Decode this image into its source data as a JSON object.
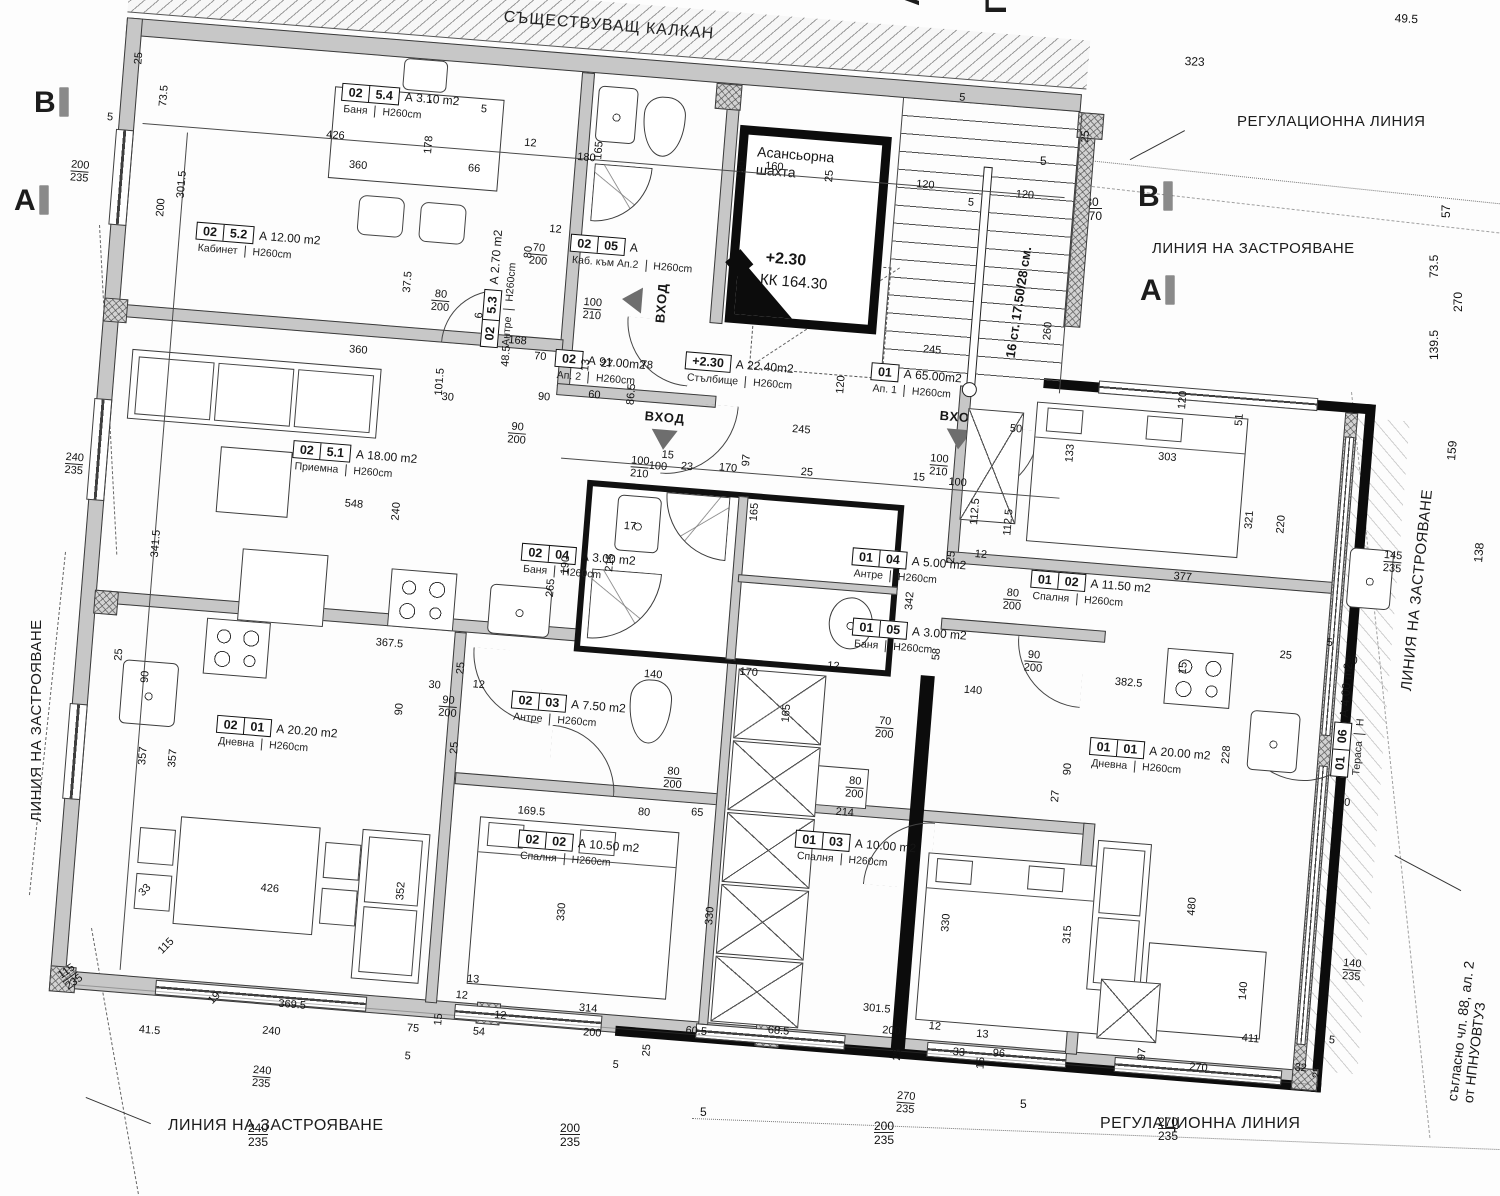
{
  "plan": {
    "kalkan": "СЪЩЕСТВУВАЩ КАЛКАН",
    "entrance_label": "ВХОД",
    "elevator": {
      "line1": "Асансьорна",
      "line2": "шахта"
    },
    "level": {
      "mark": "+2.30",
      "kk": "КК   164.30"
    },
    "stairs_note": "16 ст. 17.50/28 см.",
    "annotations": {
      "regulation_line_top": "РЕГУЛАЦИОННА ЛИНИЯ",
      "regulation_line_bottom": "РЕГУЛАЦИОННА ЛИНИЯ",
      "building_line_top": "ЛИНИЯ НА ЗАСТРОЯВАНЕ",
      "building_line_left": "ЛИНИЯ НА ЗАСТРОЯВАНЕ",
      "building_line_right": "ЛИНИЯ НА ЗАСТРОЯВАНЕ",
      "building_line_bottom": "ЛИНИЯ НА ЗАСТРОЯВАНЕ",
      "legal_note_line1": "съгласно чл. 88, ал. 2",
      "legal_note_line2": "от НПНУОВТУЗ"
    }
  },
  "section_markers": [
    {
      "l": "В",
      "x": 34,
      "y": 86
    },
    {
      "l": "А",
      "x": 14,
      "y": 184
    },
    {
      "l": "В",
      "x": 1138,
      "y": 180
    },
    {
      "l": "А",
      "x": 1140,
      "y": 274
    },
    {
      "l": "А",
      "x": 893,
      "y": 6,
      "r": -90
    },
    {
      "l": "Г",
      "x": 980,
      "y": 14,
      "r": -90
    }
  ],
  "rooms": [
    {
      "c1": "02",
      "c2": "5.4",
      "area": "А 3.10 m2",
      "name": "Баня",
      "h": "H260cm",
      "x": 212,
      "y": 48
    },
    {
      "c1": "02",
      "c2": "5.2",
      "area": "А 12.00 m2",
      "name": "Кабинет",
      "h": "H260cm",
      "x": 78,
      "y": 198
    },
    {
      "c1": "02",
      "c2": "5.3",
      "area": "А  2.70 m2",
      "name": "Антре",
      "h": "H260cm",
      "x": 370,
      "y": 300,
      "r": -90
    },
    {
      "c1": "02",
      "c2": "5.1",
      "area": "А 18.00 m2",
      "name": "Приемна",
      "h": "H260cm",
      "x": 192,
      "y": 408
    },
    {
      "c1": "02",
      "c2": "05",
      "area": "А",
      "name": "Каб. към Ап.2",
      "h": "H260cm",
      "x": 452,
      "y": 180
    },
    {
      "c1": "02",
      "c2": "",
      "area": "А  91.00m2",
      "name": "Ап. 2",
      "h": "H260cm",
      "x": 446,
      "y": 296
    },
    {
      "c1": "+2.30",
      "c2": "",
      "area": "А  22.40m2",
      "name": "Стълбище",
      "h": "H260cm",
      "x": 576,
      "y": 288
    },
    {
      "c1": "01",
      "c2": "",
      "area": "А  65.00m2",
      "name": "Ап. 1",
      "h": "H260cm",
      "x": 762,
      "y": 284
    },
    {
      "c1": "02",
      "c2": "04",
      "area": "А 3.00 m2",
      "name": "Баня",
      "h": "H260cm",
      "x": 428,
      "y": 492
    },
    {
      "c1": "01",
      "c2": "04",
      "area": "А  5.00 m2",
      "name": "Антре",
      "h": "H260cm",
      "x": 758,
      "y": 470
    },
    {
      "c1": "01",
      "c2": "05",
      "area": "А 3.00 m2",
      "name": "Баня",
      "h": "H260cm",
      "x": 764,
      "y": 540
    },
    {
      "c1": "01",
      "c2": "02",
      "area": "А 11.50 m2",
      "name": "Спалня",
      "h": "H260cm",
      "x": 938,
      "y": 478
    },
    {
      "c1": "02",
      "c2": "03",
      "area": "А  7.50 m2",
      "name": "Антре",
      "h": "H260cm",
      "x": 430,
      "y": 640
    },
    {
      "c1": "02",
      "c2": "01",
      "area": "А 20.20 m2",
      "name": "Дневна",
      "h": "H260cm",
      "x": 138,
      "y": 688
    },
    {
      "c1": "02",
      "c2": "02",
      "area": "А 10.50 m2",
      "name": "Спалня",
      "h": "H260cm",
      "x": 448,
      "y": 778
    },
    {
      "c1": "01",
      "c2": "03",
      "area": "А 10.00 m2",
      "name": "Спалня",
      "h": "H260cm",
      "x": 724,
      "y": 756
    },
    {
      "c1": "01",
      "c2": "01",
      "area": "А 20.00 m2",
      "name": "Дневна",
      "h": "H260cm",
      "x": 1010,
      "y": 640
    },
    {
      "c1": "01",
      "c2": "06",
      "area": "А 4.00 m2",
      "name": "Тераса",
      "h": "Н",
      "x": 1252,
      "y": 660,
      "r": -90
    }
  ],
  "dims": [
    {
      "t": "25",
      "x": 2,
      "y": 46,
      "r": -90
    },
    {
      "t": "73.5",
      "x": 30,
      "y": 86,
      "r": -90
    },
    {
      "t": "5",
      "x": -20,
      "y": 96
    },
    {
      "t": "200/235",
      "x": -52,
      "y": 146,
      "f": 1
    },
    {
      "t": "301.5",
      "x": 55,
      "y": 176,
      "r": -90
    },
    {
      "t": "200",
      "x": 36,
      "y": 196,
      "r": -90
    },
    {
      "t": "426",
      "x": 200,
      "y": 96
    },
    {
      "t": "178",
      "x": 298,
      "y": 112,
      "r": -90
    },
    {
      "t": "360",
      "x": 225,
      "y": 124
    },
    {
      "t": "12",
      "x": 398,
      "y": 88
    },
    {
      "t": "66",
      "x": 344,
      "y": 118
    },
    {
      "t": "5",
      "x": 352,
      "y": 58
    },
    {
      "t": "180",
      "x": 452,
      "y": 98
    },
    {
      "t": "165",
      "x": 468,
      "y": 104,
      "r": -90
    },
    {
      "t": "190",
      "x": 612,
      "y": 112,
      "r": -90
    },
    {
      "t": "160",
      "x": 640,
      "y": 92
    },
    {
      "t": "25",
      "x": 700,
      "y": 108,
      "r": -90
    },
    {
      "t": "120",
      "x": 792,
      "y": 98
    },
    {
      "t": "120",
      "x": 892,
      "y": 100
    },
    {
      "t": "5",
      "x": 828,
      "y": 8
    },
    {
      "t": "25",
      "x": 952,
      "y": 48,
      "r": -90
    },
    {
      "t": "120",
      "x": 728,
      "y": 318,
      "r": -90
    },
    {
      "t": "260",
      "x": 930,
      "y": 248,
      "r": -90
    },
    {
      "t": "5",
      "x": 845,
      "y": 112
    },
    {
      "t": "70",
      "x": 425,
      "y": 300
    },
    {
      "t": "27",
      "x": 492,
      "y": 302
    },
    {
      "t": "78",
      "x": 532,
      "y": 300
    },
    {
      "t": "12",
      "x": 430,
      "y": 172
    },
    {
      "t": "37.5",
      "x": 288,
      "y": 252,
      "r": -90
    },
    {
      "t": "80",
      "x": 406,
      "y": 208,
      "r": -90
    },
    {
      "t": "80/200",
      "x": 318,
      "y": 246,
      "f": 1
    },
    {
      "t": "6",
      "x": 362,
      "y": 272,
      "r": -90
    },
    {
      "t": "48.5",
      "x": 392,
      "y": 318,
      "r": -90
    },
    {
      "t": "360",
      "x": 240,
      "y": 308
    },
    {
      "t": "30",
      "x": 336,
      "y": 348
    },
    {
      "t": "90",
      "x": 432,
      "y": 340
    },
    {
      "t": "60",
      "x": 482,
      "y": 334
    },
    {
      "t": "86.5",
      "x": 520,
      "y": 346,
      "r": -90
    },
    {
      "t": "168",
      "x": 398,
      "y": 286
    },
    {
      "t": "90/200",
      "x": 405,
      "y": 372,
      "f": 1
    },
    {
      "t": "100/210",
      "x": 470,
      "y": 242,
      "f": 1
    },
    {
      "t": "70/200",
      "x": 412,
      "y": 192,
      "f": 1
    },
    {
      "t": "13",
      "x": 472,
      "y": 316,
      "r": -90
    },
    {
      "t": "245",
      "x": 812,
      "y": 262
    },
    {
      "t": "245",
      "x": 688,
      "y": 352
    },
    {
      "t": "97",
      "x": 640,
      "y": 398,
      "r": -90
    },
    {
      "t": "15",
      "x": 560,
      "y": 388
    },
    {
      "t": "50",
      "x": 905,
      "y": 334
    },
    {
      "t": "100/210",
      "x": 530,
      "y": 396,
      "f": 1
    },
    {
      "t": "100/210",
      "x": 828,
      "y": 370,
      "f": 1
    },
    {
      "t": "120",
      "x": 1070,
      "y": 306,
      "r": -90
    },
    {
      "t": "303",
      "x": 1055,
      "y": 350
    },
    {
      "t": "51",
      "x": 1128,
      "y": 318,
      "r": -90
    },
    {
      "t": "133",
      "x": 962,
      "y": 368,
      "r": -90
    },
    {
      "t": "321",
      "x": 1146,
      "y": 420,
      "r": -90
    },
    {
      "t": "220",
      "x": 1178,
      "y": 422,
      "r": -90
    },
    {
      "t": "377",
      "x": 1080,
      "y": 468
    },
    {
      "t": "112.5",
      "x": 872,
      "y": 438,
      "r": -90
    },
    {
      "t": "112.5",
      "x": 906,
      "y": 446,
      "r": -90
    },
    {
      "t": "25",
      "x": 852,
      "y": 478,
      "r": -90
    },
    {
      "t": "12",
      "x": 880,
      "y": 462
    },
    {
      "t": "145/235",
      "x": 1288,
      "y": 430,
      "f": 1
    },
    {
      "t": "80/200",
      "x": 912,
      "y": 498,
      "f": 1
    },
    {
      "t": "17",
      "x": 528,
      "y": 462
    },
    {
      "t": "100",
      "x": 548,
      "y": 400
    },
    {
      "t": "23",
      "x": 580,
      "y": 398
    },
    {
      "t": "170",
      "x": 618,
      "y": 396
    },
    {
      "t": "165",
      "x": 652,
      "y": 452,
      "r": -90
    },
    {
      "t": "25",
      "x": 700,
      "y": 394
    },
    {
      "t": "215",
      "x": 512,
      "y": 514,
      "r": -90
    },
    {
      "t": "265",
      "x": 455,
      "y": 544,
      "r": -90
    },
    {
      "t": "190",
      "x": 468,
      "y": 520,
      "r": -90
    },
    {
      "t": "100",
      "x": 848,
      "y": 392
    },
    {
      "t": "15",
      "x": 812,
      "y": 390
    },
    {
      "t": "342",
      "x": 814,
      "y": 528,
      "r": -90
    },
    {
      "t": "58",
      "x": 845,
      "y": 576,
      "r": -90
    },
    {
      "t": "170",
      "x": 655,
      "y": 598
    },
    {
      "t": "165",
      "x": 700,
      "y": 650,
      "r": -90
    },
    {
      "t": "12",
      "x": 742,
      "y": 585
    },
    {
      "t": "140",
      "x": 560,
      "y": 608
    },
    {
      "t": "140",
      "x": 880,
      "y": 598
    },
    {
      "t": "70/200",
      "x": 795,
      "y": 636,
      "f": 1
    },
    {
      "t": "80/200",
      "x": 770,
      "y": 698,
      "f": 1
    },
    {
      "t": "90/200",
      "x": 938,
      "y": 558,
      "f": 1
    },
    {
      "t": "80/200",
      "x": 588,
      "y": 703,
      "f": 1
    },
    {
      "t": "548",
      "x": 248,
      "y": 462
    },
    {
      "t": "367.5",
      "x": 290,
      "y": 598
    },
    {
      "t": "341.5",
      "x": 58,
      "y": 536,
      "r": -90
    },
    {
      "t": "240",
      "x": 295,
      "y": 480,
      "r": -90
    },
    {
      "t": "101.5",
      "x": 328,
      "y": 352,
      "r": -90
    },
    {
      "t": "240/235",
      "x": -34,
      "y": 438,
      "f": 1
    },
    {
      "t": "357",
      "x": 62,
      "y": 744,
      "r": -90
    },
    {
      "t": "357",
      "x": 92,
      "y": 744,
      "r": -90
    },
    {
      "t": "115/235",
      "x": -2,
      "y": 958,
      "f": 1,
      "r": -40
    },
    {
      "t": "30",
      "x": 346,
      "y": 636
    },
    {
      "t": "90",
      "x": 314,
      "y": 674,
      "r": -90
    },
    {
      "t": "90/200",
      "x": 358,
      "y": 650,
      "f": 1
    },
    {
      "t": "12",
      "x": 390,
      "y": 632
    },
    {
      "t": "25",
      "x": 372,
      "y": 628,
      "r": -90
    },
    {
      "t": "25",
      "x": 372,
      "y": 708,
      "r": -90
    },
    {
      "t": "90",
      "x": 58,
      "y": 662,
      "r": -90
    },
    {
      "t": "25",
      "x": 30,
      "y": 642,
      "r": -90
    },
    {
      "t": "426",
      "x": 195,
      "y": 852
    },
    {
      "t": "33",
      "x": 72,
      "y": 870,
      "r": -50
    },
    {
      "t": "115",
      "x": 96,
      "y": 926,
      "r": -50
    },
    {
      "t": "19",
      "x": 150,
      "y": 972,
      "r": -50
    },
    {
      "t": "369.5",
      "x": 222,
      "y": 966
    },
    {
      "t": "41.5",
      "x": 85,
      "y": 1003
    },
    {
      "t": "240",
      "x": 208,
      "y": 994
    },
    {
      "t": "352",
      "x": 330,
      "y": 858,
      "r": -90
    },
    {
      "t": "75",
      "x": 352,
      "y": 980
    },
    {
      "t": "15",
      "x": 378,
      "y": 980,
      "r": -90
    },
    {
      "t": "12",
      "x": 398,
      "y": 943
    },
    {
      "t": "13",
      "x": 408,
      "y": 926
    },
    {
      "t": "240/235",
      "x": 202,
      "y": 1034,
      "f": 1
    },
    {
      "t": "5",
      "x": 352,
      "y": 1008
    },
    {
      "t": "169.5",
      "x": 445,
      "y": 754
    },
    {
      "t": "80",
      "x": 565,
      "y": 746
    },
    {
      "t": "65",
      "x": 618,
      "y": 742
    },
    {
      "t": "214",
      "x": 762,
      "y": 730
    },
    {
      "t": "330",
      "x": 492,
      "y": 866,
      "r": -90
    },
    {
      "t": "330",
      "x": 640,
      "y": 858,
      "r": -90
    },
    {
      "t": "330",
      "x": 876,
      "y": 846,
      "r": -90
    },
    {
      "t": "314",
      "x": 522,
      "y": 946
    },
    {
      "t": "301.5",
      "x": 805,
      "y": 923
    },
    {
      "t": "54",
      "x": 418,
      "y": 978
    },
    {
      "t": "200",
      "x": 528,
      "y": 970
    },
    {
      "t": "60.5",
      "x": 630,
      "y": 960
    },
    {
      "t": "68.5",
      "x": 712,
      "y": 953
    },
    {
      "t": "200",
      "x": 826,
      "y": 944
    },
    {
      "t": "12",
      "x": 438,
      "y": 960
    },
    {
      "t": "25",
      "x": 588,
      "y": 994,
      "r": -90
    },
    {
      "t": "25",
      "x": 838,
      "y": 978,
      "r": -90
    },
    {
      "t": "5",
      "x": 560,
      "y": 1000
    },
    {
      "t": "382.5",
      "x": 1030,
      "y": 578
    },
    {
      "t": "228",
      "x": 1142,
      "y": 656,
      "r": -90
    },
    {
      "t": "480",
      "x": 1120,
      "y": 810,
      "r": -90
    },
    {
      "t": "315",
      "x": 998,
      "y": 848,
      "r": -90
    },
    {
      "t": "27",
      "x": 975,
      "y": 708,
      "r": -90
    },
    {
      "t": "90",
      "x": 985,
      "y": 680,
      "r": -90
    },
    {
      "t": "15",
      "x": 1092,
      "y": 570,
      "r": -90
    },
    {
      "t": "25",
      "x": 1192,
      "y": 538
    },
    {
      "t": "5",
      "x": 1238,
      "y": 522
    },
    {
      "t": "60",
      "x": 1258,
      "y": 538
    },
    {
      "t": "90",
      "x": 1262,
      "y": 680
    },
    {
      "t": "140",
      "x": 1178,
      "y": 890,
      "r": -90
    },
    {
      "t": "140/235",
      "x": 1280,
      "y": 840,
      "f": 1
    },
    {
      "t": "411",
      "x": 1185,
      "y": 923
    },
    {
      "t": "270",
      "x": 1135,
      "y": 956
    },
    {
      "t": "96",
      "x": 938,
      "y": 958
    },
    {
      "t": "33",
      "x": 898,
      "y": 960
    },
    {
      "t": "13",
      "x": 920,
      "y": 940
    },
    {
      "t": "12",
      "x": 872,
      "y": 936
    },
    {
      "t": "97",
      "x": 1082,
      "y": 958,
      "r": -90
    },
    {
      "t": "32",
      "x": 1240,
      "y": 948
    },
    {
      "t": "25",
      "x": 1258,
      "y": 962,
      "r": -90
    },
    {
      "t": "5",
      "x": 1272,
      "y": 918
    },
    {
      "t": "270/235",
      "x": 846,
      "y": 1008,
      "f": 1
    },
    {
      "t": "15",
      "x": 922,
      "y": 980,
      "r": -90
    }
  ],
  "sheet_dims": [
    {
      "t": "323",
      "x": 1185,
      "y": 55,
      "r": 3
    },
    {
      "t": "49.5",
      "x": 1395,
      "y": 12,
      "r": 3
    },
    {
      "t": "57",
      "x": 1440,
      "y": 218,
      "r": -90
    },
    {
      "t": "73.5",
      "x": 1428,
      "y": 278,
      "r": -90
    },
    {
      "t": "270",
      "x": 1452,
      "y": 312,
      "r": -90
    },
    {
      "t": "139.5",
      "x": 1428,
      "y": 360,
      "r": -90
    },
    {
      "t": "159",
      "x": 1445,
      "y": 460,
      "r": -85
    },
    {
      "t": "138",
      "x": 1472,
      "y": 562,
      "r": -85
    },
    {
      "t": "80/170",
      "x": 1082,
      "y": 196,
      "f": 1
    },
    {
      "t": "5",
      "x": 1040,
      "y": 155
    },
    {
      "t": "240/235",
      "x": 248,
      "y": 1122,
      "f": 1
    },
    {
      "t": "200/235",
      "x": 560,
      "y": 1122,
      "f": 1
    },
    {
      "t": "200/235",
      "x": 874,
      "y": 1120,
      "f": 1
    },
    {
      "t": "270/235",
      "x": 1158,
      "y": 1116,
      "f": 1
    },
    {
      "t": "5",
      "x": 700,
      "y": 1106
    },
    {
      "t": "5",
      "x": 1020,
      "y": 1098
    }
  ]
}
